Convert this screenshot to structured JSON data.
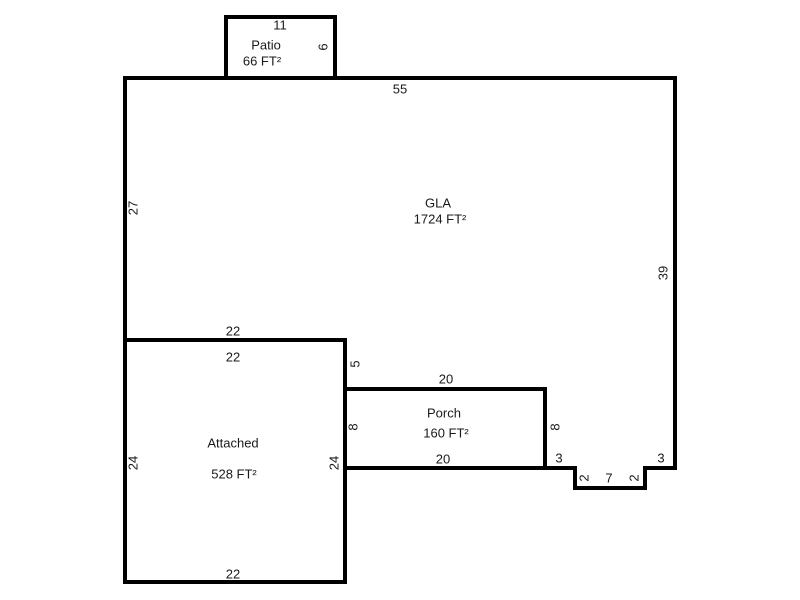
{
  "canvas": {
    "width": 800,
    "height": 600,
    "background": "#ffffff"
  },
  "style": {
    "wall_color": "#000000",
    "wall_thickness": 4,
    "text_color": "#1a1a1a",
    "font_size": 13
  },
  "floor_plan": {
    "title": "Floor plan sketch",
    "areas": [
      {
        "id": "gla",
        "name": "GLA",
        "area_label": "1724 FT²",
        "points": [
          [
            125,
            78
          ],
          [
            675,
            78
          ],
          [
            675,
            468
          ],
          [
            645,
            468
          ],
          [
            645,
            488
          ],
          [
            575,
            488
          ],
          [
            575,
            468
          ],
          [
            545,
            468
          ],
          [
            545,
            389
          ],
          [
            345,
            389
          ],
          [
            345,
            340
          ],
          [
            125,
            340
          ]
        ]
      },
      {
        "id": "attached",
        "name": "Attached",
        "area_label": "528 FT²",
        "points": [
          [
            125,
            340
          ],
          [
            345,
            340
          ],
          [
            345,
            582
          ],
          [
            125,
            582
          ]
        ]
      },
      {
        "id": "porch",
        "name": "Porch",
        "area_label": "160 FT²",
        "points": [
          [
            345,
            389
          ],
          [
            545,
            389
          ],
          [
            545,
            468
          ],
          [
            345,
            468
          ]
        ]
      },
      {
        "id": "patio",
        "name": "Patio",
        "area_label": "66 FT²",
        "points": [
          [
            226,
            17
          ],
          [
            335,
            17
          ],
          [
            335,
            78
          ],
          [
            226,
            78
          ]
        ]
      }
    ],
    "labels": [
      {
        "name": "patio-width-dim",
        "text": "11",
        "x": 280,
        "y": 25,
        "rotate": 0
      },
      {
        "name": "patio-name",
        "text": "Patio",
        "x": 266,
        "y": 45,
        "rotate": 0
      },
      {
        "name": "patio-area",
        "text": "66 FT²",
        "x": 262,
        "y": 61,
        "rotate": 0
      },
      {
        "name": "patio-height-dim",
        "text": "6",
        "x": 323,
        "y": 47,
        "rotate": -90
      },
      {
        "name": "gla-top-dim",
        "text": "55",
        "x": 400,
        "y": 89,
        "rotate": 0
      },
      {
        "name": "gla-left-dim",
        "text": "27",
        "x": 133,
        "y": 208,
        "rotate": -90
      },
      {
        "name": "gla-name",
        "text": "GLA",
        "x": 438,
        "y": 203,
        "rotate": 0
      },
      {
        "name": "gla-area",
        "text": "1724 FT²",
        "x": 440,
        "y": 219,
        "rotate": 0
      },
      {
        "name": "gla-right-dim",
        "text": "39",
        "x": 663,
        "y": 273,
        "rotate": -90
      },
      {
        "name": "gla-bottom-left-dim",
        "text": "22",
        "x": 233,
        "y": 331,
        "rotate": 0
      },
      {
        "name": "attached-top-dim",
        "text": "22",
        "x": 233,
        "y": 357,
        "rotate": 0
      },
      {
        "name": "gla-step-dim",
        "text": "5",
        "x": 355,
        "y": 364,
        "rotate": -90
      },
      {
        "name": "porch-top-dim",
        "text": "20",
        "x": 446,
        "y": 379,
        "rotate": 0
      },
      {
        "name": "porch-name",
        "text": "Porch",
        "x": 444,
        "y": 413,
        "rotate": 0
      },
      {
        "name": "porch-area",
        "text": "160 FT²",
        "x": 446,
        "y": 433,
        "rotate": 0
      },
      {
        "name": "porch-left-dim",
        "text": "8",
        "x": 353,
        "y": 427,
        "rotate": -90
      },
      {
        "name": "porch-right-dim",
        "text": "8",
        "x": 555,
        "y": 427,
        "rotate": -90
      },
      {
        "name": "porch-bottom-dim",
        "text": "20",
        "x": 443,
        "y": 459,
        "rotate": 0
      },
      {
        "name": "gla-bottom-dim-3-left",
        "text": "3",
        "x": 559,
        "y": 458,
        "rotate": 0
      },
      {
        "name": "gla-bottom-dim-3-right",
        "text": "3",
        "x": 661,
        "y": 458,
        "rotate": 0
      },
      {
        "name": "notch-left-dim",
        "text": "2",
        "x": 584,
        "y": 478,
        "rotate": -90
      },
      {
        "name": "notch-bottom-dim",
        "text": "7",
        "x": 609,
        "y": 478,
        "rotate": 0
      },
      {
        "name": "notch-right-dim",
        "text": "2",
        "x": 634,
        "y": 478,
        "rotate": -90
      },
      {
        "name": "attached-name",
        "text": "Attached",
        "x": 233,
        "y": 443,
        "rotate": 0
      },
      {
        "name": "attached-left-dim",
        "text": "24",
        "x": 133,
        "y": 463,
        "rotate": -90
      },
      {
        "name": "attached-right-dim",
        "text": "24",
        "x": 334,
        "y": 463,
        "rotate": -90
      },
      {
        "name": "attached-area",
        "text": "528 FT²",
        "x": 234,
        "y": 474,
        "rotate": 0
      },
      {
        "name": "attached-bottom-dim",
        "text": "22",
        "x": 233,
        "y": 574,
        "rotate": 0
      }
    ]
  }
}
